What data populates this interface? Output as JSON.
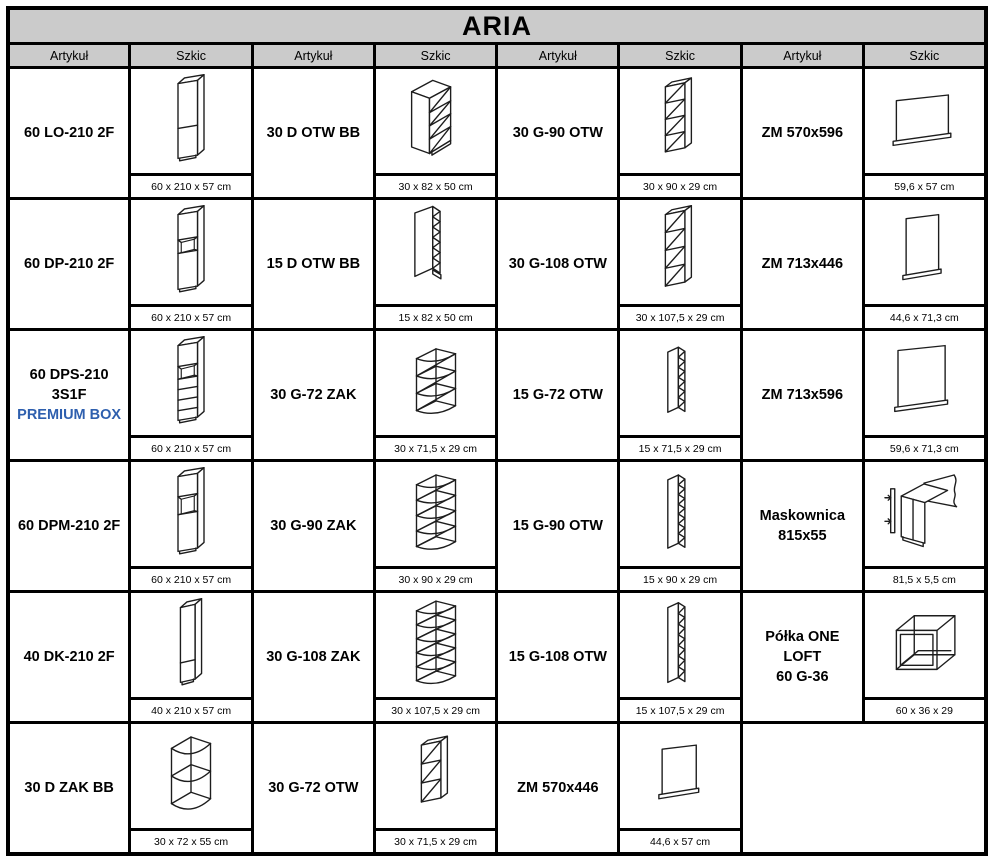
{
  "title": "ARIA",
  "header": {
    "artykul_label": "Artykuł",
    "szkic_label": "Szkic",
    "repeat": 4
  },
  "colors": {
    "header_bg": "#cbcbcb",
    "title_bg": "#cbcbcb",
    "border": "#000000",
    "premium_blue": "#2e5fae",
    "sketch_stroke": "#1d1d1d"
  },
  "rows": [
    {
      "cells": [
        {
          "article": {
            "lines": [
              "60 LO-210 2F"
            ]
          },
          "sketch": {
            "type": "tall-larder-2-front",
            "dims": "60 x 210 x 57 cm"
          }
        },
        {
          "article": {
            "lines": [
              "30 D OTW BB"
            ]
          },
          "sketch": {
            "type": "base-open-shelf-30",
            "dims": "30 x 82 x 50 cm"
          }
        },
        {
          "article": {
            "lines": [
              "30 G-90 OTW"
            ]
          },
          "sketch": {
            "type": "wall-open-90",
            "dims": "30 x 90 x 29 cm"
          }
        },
        {
          "article": {
            "lines": [
              "ZM 570x596"
            ]
          },
          "sketch": {
            "type": "panel-570x596",
            "dims": "59,6 x 57 cm"
          }
        }
      ]
    },
    {
      "cells": [
        {
          "article": {
            "lines": [
              "60 DP-210 2F"
            ]
          },
          "sketch": {
            "type": "tall-oven-housing",
            "dims": "60 x 210 x 57 cm"
          }
        },
        {
          "article": {
            "lines": [
              "15 D OTW BB"
            ]
          },
          "sketch": {
            "type": "base-open-shelf-15",
            "dims": "15 x 82 x 50 cm"
          }
        },
        {
          "article": {
            "lines": [
              "30 G-108 OTW"
            ]
          },
          "sketch": {
            "type": "wall-open-108",
            "dims": "30 x 107,5 x 29 cm"
          }
        },
        {
          "article": {
            "lines": [
              "ZM 713x446"
            ]
          },
          "sketch": {
            "type": "panel-713x446",
            "dims": "44,6 x 71,3 cm"
          }
        }
      ]
    },
    {
      "cells": [
        {
          "article": {
            "lines": [
              "60 DPS-210 3S1F",
              "PREMIUM BOX"
            ],
            "accent_line": 1
          },
          "sketch": {
            "type": "tall-oven-3-drawers",
            "dims": "60 x 210 x 57 cm"
          }
        },
        {
          "article": {
            "lines": [
              "30 G-72 ZAK"
            ]
          },
          "sketch": {
            "type": "corner-shelf-72",
            "dims": "30 x 71,5 x 29 cm"
          }
        },
        {
          "article": {
            "lines": [
              "15 G-72 OTW"
            ]
          },
          "sketch": {
            "type": "wall-open-narrow-72",
            "dims": "15 x 71,5 x 29 cm"
          }
        },
        {
          "article": {
            "lines": [
              "ZM 713x596"
            ]
          },
          "sketch": {
            "type": "panel-713x596",
            "dims": "59,6 x 71,3 cm"
          }
        }
      ]
    },
    {
      "cells": [
        {
          "article": {
            "lines": [
              "60 DPM-210 2F"
            ]
          },
          "sketch": {
            "type": "tall-oven-mid",
            "dims": "60 x 210 x 57 cm"
          }
        },
        {
          "article": {
            "lines": [
              "30 G-90 ZAK"
            ]
          },
          "sketch": {
            "type": "corner-shelf-90",
            "dims": "30 x 90 x 29 cm"
          }
        },
        {
          "article": {
            "lines": [
              "15 G-90 OTW"
            ]
          },
          "sketch": {
            "type": "wall-open-narrow-90",
            "dims": "15 x 90 x 29 cm"
          }
        },
        {
          "article": {
            "lines": [
              "Maskownica",
              "815x55"
            ]
          },
          "sketch": {
            "type": "maskownica-strip",
            "dims": "81,5 x 5,5 cm"
          }
        }
      ]
    },
    {
      "cells": [
        {
          "article": {
            "lines": [
              "40 DK-210 2F"
            ]
          },
          "sketch": {
            "type": "tall-larder-40",
            "dims": "40 x 210 x 57 cm"
          }
        },
        {
          "article": {
            "lines": [
              "30 G-108 ZAK"
            ]
          },
          "sketch": {
            "type": "corner-shelf-108",
            "dims": "30 x 107,5 x 29 cm"
          }
        },
        {
          "article": {
            "lines": [
              "15 G-108 OTW"
            ]
          },
          "sketch": {
            "type": "wall-open-narrow-108",
            "dims": "15 x 107,5 x 29 cm"
          }
        },
        {
          "article": {
            "lines": [
              "Półka ONE LOFT",
              "60 G-36"
            ]
          },
          "sketch": {
            "type": "loft-shelf-frame",
            "dims": "60 x 36 x 29"
          }
        }
      ]
    },
    {
      "cells": [
        {
          "article": {
            "lines": [
              "30 D ZAK BB"
            ]
          },
          "sketch": {
            "type": "corner-shelf-base",
            "dims": "30 x 72 x 55 cm"
          }
        },
        {
          "article": {
            "lines": [
              "30 G-72 OTW"
            ]
          },
          "sketch": {
            "type": "wall-open-72",
            "dims": "30 x 71,5 x 29 cm"
          }
        },
        {
          "article": {
            "lines": [
              "ZM 570x446"
            ]
          },
          "sketch": {
            "type": "panel-570x446",
            "dims": "44,6 x 57 cm"
          }
        },
        null
      ]
    }
  ]
}
